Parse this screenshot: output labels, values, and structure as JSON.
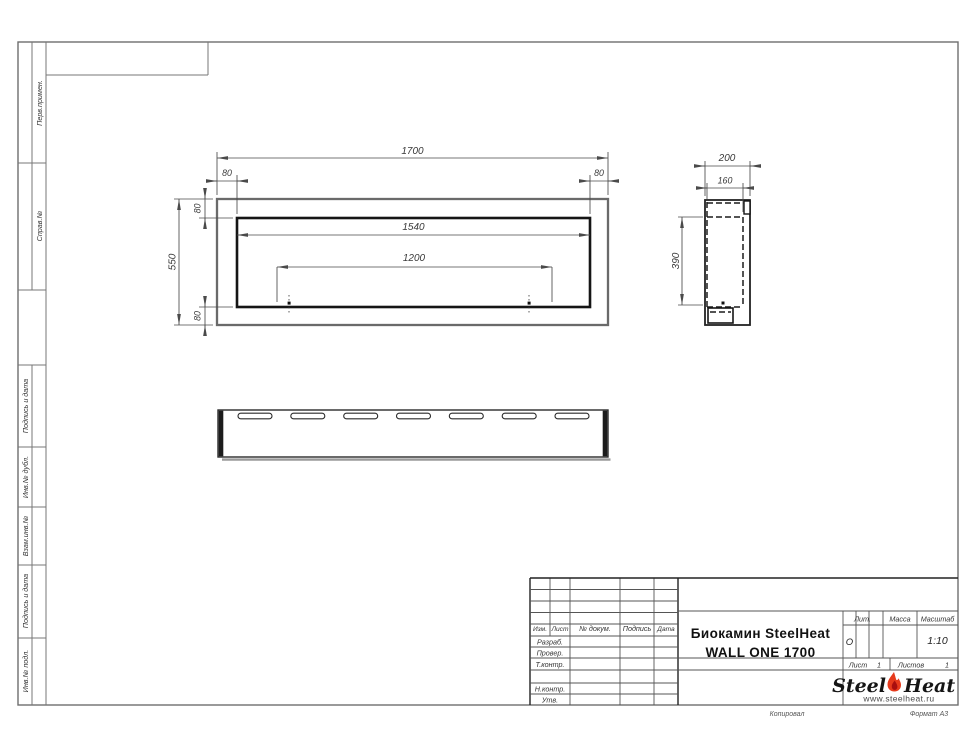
{
  "sheet": {
    "margin_labels": [
      "Перв.примен.",
      "Справ.№",
      "Подпись и дата",
      "Инв.№ дубл.",
      "Взам.инв.№",
      "Подпись и дата",
      "Инв.№ подл."
    ],
    "footer": {
      "copied": "Копировал",
      "format": "Формат А3"
    }
  },
  "views": {
    "front": {
      "width": "1700",
      "inner_width": "1540",
      "burner_width": "1200",
      "height": "550",
      "margin_left": "80",
      "margin_right": "80",
      "margin_top": "80",
      "margin_bottom": "80"
    },
    "side": {
      "depth": "200",
      "inner_depth": "160",
      "inner_height": "390"
    }
  },
  "title_block": {
    "product_line1": "Биокамин SteelHeat",
    "product_line2": "WALL ONE 1700",
    "headers": {
      "izm": "Изм.",
      "list": "Лист",
      "doc": "№ докум.",
      "sign": "Подпись",
      "date": "Дата"
    },
    "rows": {
      "razrab": "Разраб.",
      "prover": "Провер.",
      "tkontr": "Т.контр.",
      "nkontr": "Н.контр.",
      "utv": "Утв."
    },
    "lit_label": "Лит.",
    "mass_label": "Масса",
    "scale_label": "Масштаб",
    "lit_value": "О",
    "scale_value": "1:10",
    "sheet_label": "Лист",
    "sheet_value": "1",
    "sheets_label": "Листов",
    "sheets_value": "1",
    "logo": {
      "steel": "Steel",
      "heat": "Heat",
      "site": "www.steelheat.ru"
    },
    "accent_colors": {
      "flame_outer": "#e63a1c",
      "flame_inner": "#a80f0f"
    }
  }
}
